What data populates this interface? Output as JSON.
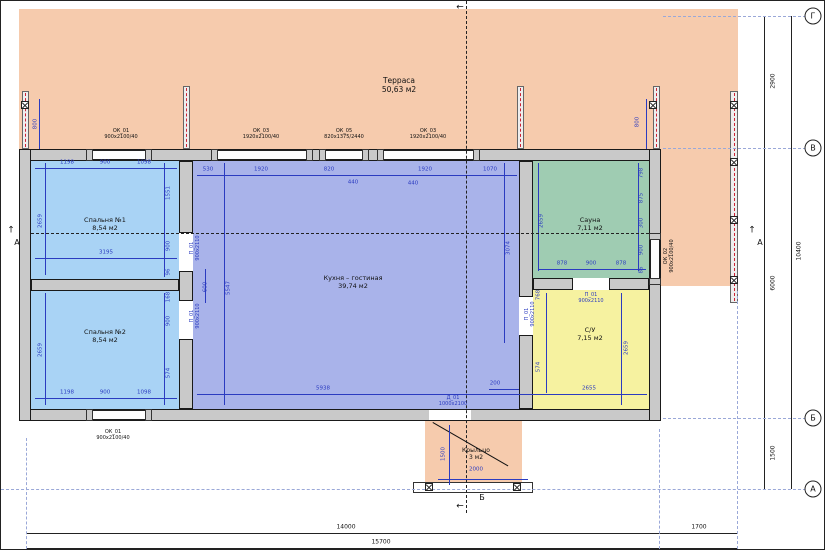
{
  "drawing": {
    "type": "floor-plan",
    "rooms": [
      {
        "name": "Терраса",
        "area": "50,63 м2",
        "x": 398,
        "y": 84,
        "s": 7.5
      },
      {
        "name": "Спальня №1",
        "area": "8,54 м2",
        "x": 104,
        "y": 224,
        "s": 6.5
      },
      {
        "name": "Спальня №2",
        "area": "8,54 м2",
        "x": 104,
        "y": 336,
        "s": 6.5
      },
      {
        "name": "Кухня – гостиная",
        "area": "39,74 м2",
        "x": 352,
        "y": 282,
        "s": 6.5
      },
      {
        "name": "Сауна",
        "area": "7,11 м2",
        "x": 589,
        "y": 224,
        "s": 6.5
      },
      {
        "name": "С/У",
        "area": "7,15 м2",
        "x": 589,
        "y": 334,
        "s": 6.5
      },
      {
        "name": "Крыльцо",
        "area": "3 м2",
        "x": 475,
        "y": 453,
        "s": 6
      }
    ],
    "tags": [
      {
        "t": "ОК_01\n900х2100/40",
        "x": 120,
        "y": 133
      },
      {
        "t": "ОК_03\n1920х2100/40",
        "x": 260,
        "y": 133
      },
      {
        "t": "ОК_05\n820х1375/2440",
        "x": 343,
        "y": 133
      },
      {
        "t": "ОК_03\n1920х2100/40",
        "x": 427,
        "y": 133
      },
      {
        "t": "ОК_01\n900х2100/40",
        "x": 112,
        "y": 434
      },
      {
        "t": "ОК_02\n900х2100/40",
        "x": 668,
        "y": 255,
        "r": 1
      }
    ],
    "door_tags": [
      {
        "t": "П_01\n900х2110",
        "x": 194,
        "y": 247,
        "r": 1
      },
      {
        "t": "П_01\n900х2110",
        "x": 194,
        "y": 315,
        "r": 1
      },
      {
        "t": "П_01\n900х2110",
        "x": 529,
        "y": 313,
        "r": 1
      },
      {
        "t": "П_01\n900х2110",
        "x": 590,
        "y": 297
      },
      {
        "t": "Д_01\n1000х2100",
        "x": 452,
        "y": 400
      }
    ],
    "dims_blue": [
      {
        "t": "1198",
        "x": 66,
        "y": 162
      },
      {
        "t": "900",
        "x": 104,
        "y": 162
      },
      {
        "t": "1098",
        "x": 143,
        "y": 162
      },
      {
        "t": "2659",
        "x": 40,
        "y": 220,
        "r": 1
      },
      {
        "t": "3195",
        "x": 105,
        "y": 252
      },
      {
        "t": "1551",
        "x": 168,
        "y": 192,
        "r": 1
      },
      {
        "t": "900",
        "x": 168,
        "y": 245,
        "r": 1
      },
      {
        "t": "96",
        "x": 168,
        "y": 271,
        "r": 1
      },
      {
        "t": "2659",
        "x": 40,
        "y": 349,
        "r": 1
      },
      {
        "t": "1198",
        "x": 66,
        "y": 392
      },
      {
        "t": "900",
        "x": 104,
        "y": 392
      },
      {
        "t": "1098",
        "x": 143,
        "y": 392
      },
      {
        "t": "168",
        "x": 168,
        "y": 296,
        "r": 1
      },
      {
        "t": "900",
        "x": 168,
        "y": 320,
        "r": 1
      },
      {
        "t": "574",
        "x": 168,
        "y": 372,
        "r": 1
      },
      {
        "t": "530",
        "x": 207,
        "y": 169
      },
      {
        "t": "1920",
        "x": 260,
        "y": 169
      },
      {
        "t": "820",
        "x": 328,
        "y": 169
      },
      {
        "t": "1920",
        "x": 424,
        "y": 169
      },
      {
        "t": "1070",
        "x": 489,
        "y": 169
      },
      {
        "t": "440",
        "x": 352,
        "y": 182
      },
      {
        "t": "440",
        "x": 412,
        "y": 183
      },
      {
        "t": "5547",
        "x": 228,
        "y": 287,
        "r": 1
      },
      {
        "t": "3074",
        "x": 508,
        "y": 247,
        "r": 1
      },
      {
        "t": "5938",
        "x": 322,
        "y": 388
      },
      {
        "t": "200",
        "x": 494,
        "y": 383
      },
      {
        "t": "600",
        "x": 205,
        "y": 286,
        "r": 1
      },
      {
        "t": "2659",
        "x": 541,
        "y": 220,
        "r": 1
      },
      {
        "t": "878",
        "x": 561,
        "y": 263
      },
      {
        "t": "900",
        "x": 590,
        "y": 263
      },
      {
        "t": "878",
        "x": 620,
        "y": 263
      },
      {
        "t": "798",
        "x": 641,
        "y": 172,
        "r": 1
      },
      {
        "t": "875",
        "x": 641,
        "y": 197,
        "r": 1
      },
      {
        "t": "300",
        "x": 641,
        "y": 222,
        "r": 1
      },
      {
        "t": "900",
        "x": 641,
        "y": 249,
        "r": 1
      },
      {
        "t": "86",
        "x": 641,
        "y": 269,
        "r": 1
      },
      {
        "t": "2659",
        "x": 626,
        "y": 347,
        "r": 1
      },
      {
        "t": "2655",
        "x": 588,
        "y": 388
      },
      {
        "t": "768",
        "x": 538,
        "y": 294,
        "r": 1
      },
      {
        "t": "574",
        "x": 538,
        "y": 366,
        "r": 1
      },
      {
        "t": "1500",
        "x": 443,
        "y": 453,
        "r": 1
      },
      {
        "t": "2000",
        "x": 475,
        "y": 469
      },
      {
        "t": "800",
        "x": 35,
        "y": 123,
        "r": 1
      },
      {
        "t": "800",
        "x": 637,
        "y": 121,
        "r": 1
      }
    ],
    "dims_black": [
      {
        "t": "2900",
        "x": 772,
        "y": 80,
        "r": 1
      },
      {
        "t": "6000",
        "x": 772,
        "y": 282,
        "r": 1
      },
      {
        "t": "1500",
        "x": 772,
        "y": 452,
        "r": 1
      },
      {
        "t": "10400",
        "x": 798,
        "y": 250,
        "r": 1
      },
      {
        "t": "14000",
        "x": 345,
        "y": 526
      },
      {
        "t": "1700",
        "x": 698,
        "y": 526
      },
      {
        "t": "15700",
        "x": 380,
        "y": 541
      }
    ],
    "section_marks": [
      {
        "t": "А",
        "x": 16,
        "y": 242,
        "s": 8
      },
      {
        "t": "А",
        "x": 759,
        "y": 242,
        "s": 8
      },
      {
        "t": "Б",
        "x": 481,
        "y": 497,
        "s": 8
      },
      {
        "t": "↑",
        "x": 10,
        "y": 230,
        "s": 9
      },
      {
        "t": "↑",
        "x": 751,
        "y": 230,
        "s": 9
      },
      {
        "t": "←",
        "x": 459,
        "y": 7,
        "s": 9
      },
      {
        "t": "←",
        "x": 459,
        "y": 506,
        "s": 9
      }
    ],
    "grid_axes": [
      {
        "letter": "Г",
        "y": 15
      },
      {
        "letter": "В",
        "y": 147
      },
      {
        "letter": "Б",
        "y": 417
      },
      {
        "letter": "А",
        "y": 488
      }
    ],
    "colors": {
      "terrace": "#f6cbad",
      "bedroom": "#a9d3f5",
      "kitchen": "#a9b3ea",
      "sauna": "#9fccb2",
      "bathroom": "#f6f2a0",
      "wall": "#c9c9c9",
      "dim_blue": "#2b3bc0",
      "axis": "#9aa8d8"
    }
  }
}
